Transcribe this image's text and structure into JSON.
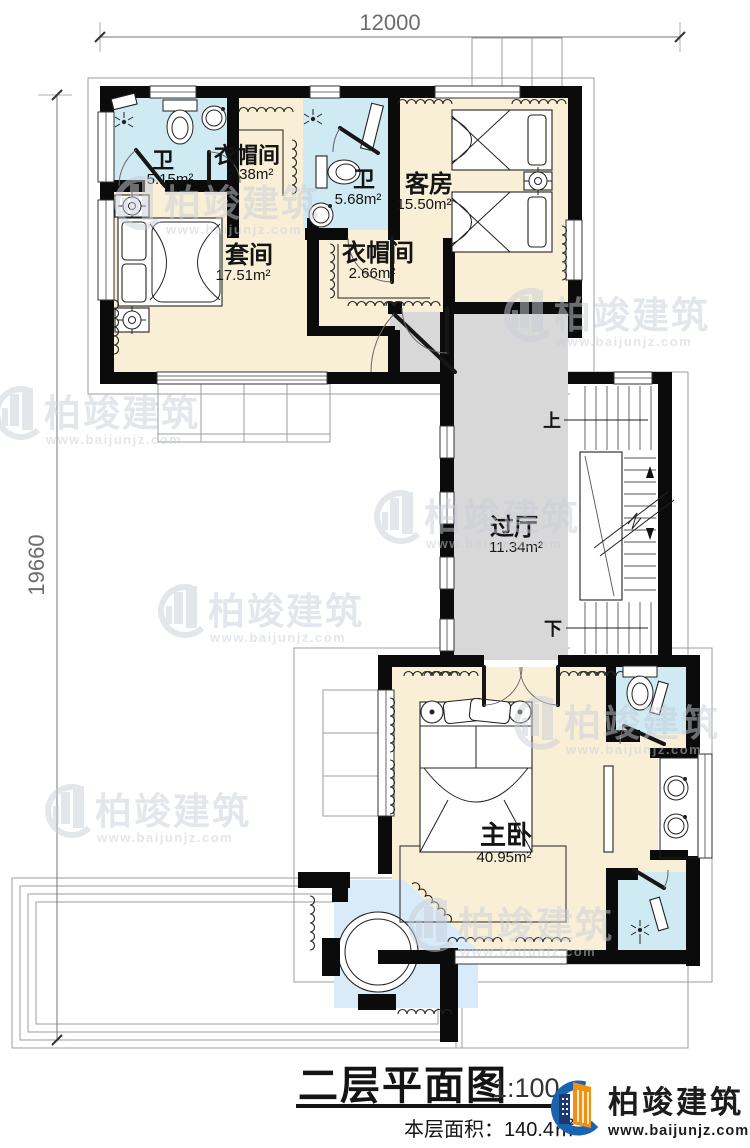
{
  "dimensions": {
    "top": "12000",
    "left": "19660"
  },
  "rooms": {
    "bath1": {
      "name": "卫",
      "area": "5.15m²"
    },
    "cloak1": {
      "name": "衣帽间",
      "area": "2.38m²"
    },
    "bath2": {
      "name": "卫",
      "area": "5.68m²"
    },
    "guest": {
      "name": "客房",
      "area": "15.50m²"
    },
    "suite": {
      "name": "套间",
      "area": "17.51m²"
    },
    "cloak2": {
      "name": "衣帽间",
      "area": "2.66m²"
    },
    "hall": {
      "name": "过厅",
      "area": "11.34m²"
    },
    "master": {
      "name": "主卧",
      "area": "40.95m²"
    }
  },
  "stairs": {
    "up_label": "上",
    "down_label": "下"
  },
  "title_block": {
    "title": "二层平面图",
    "scale": "1:100",
    "floor_area_label": "本层面积：140.4㎡"
  },
  "brand": {
    "name": "柏竣建筑",
    "website": "www.baijunjz.com"
  },
  "watermark": {
    "name": "柏竣建筑",
    "website": "www.baijunjz.com"
  },
  "colors": {
    "room_cream": "#f8efd6",
    "bath_blue": "#cfeaf2",
    "hall_gray": "#d8d8d8",
    "tub_blue": "#d9ebf8",
    "wall_black": "#0b0b0b",
    "watermark_gray": "#c9ced9",
    "logo_blue": "#1a63b0",
    "logo_navy": "#1d3a70",
    "logo_orange": "#f29110"
  }
}
